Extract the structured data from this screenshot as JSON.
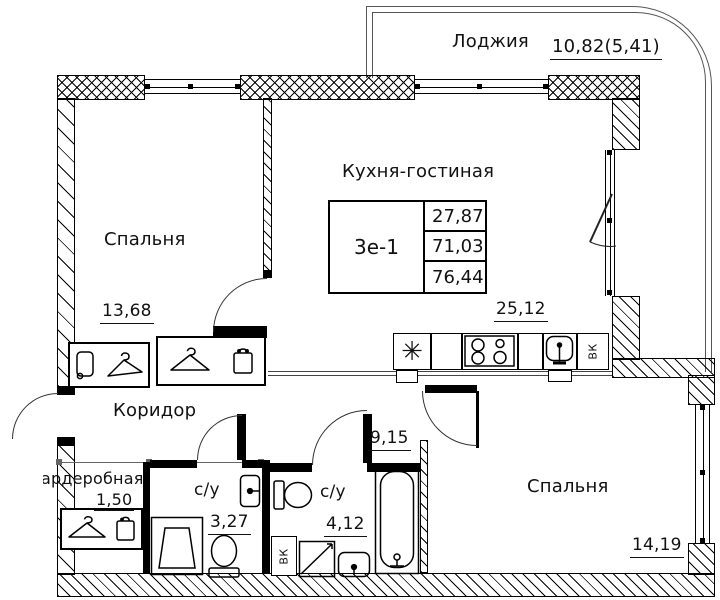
{
  "plan": {
    "title": "Apartment floor plan 3e-1",
    "rooms": [
      {
        "id": "loggia",
        "name": "Лоджия",
        "area": "10,82(5,41)"
      },
      {
        "id": "bedroom-left",
        "name": "Спальня",
        "area": "13,68"
      },
      {
        "id": "kitchen-living",
        "name": "Кухня-гостиная",
        "area": "25,12"
      },
      {
        "id": "corridor",
        "name": "Коридор",
        "area": "9,15"
      },
      {
        "id": "wardrobe-room",
        "name": "Гардеробная",
        "area": "1,50"
      },
      {
        "id": "bathroom-1",
        "name": "с/у",
        "area": "3,27"
      },
      {
        "id": "bathroom-2",
        "name": "с/у",
        "area": "4,12"
      },
      {
        "id": "bedroom-right",
        "name": "Спальня",
        "area": "14,19"
      }
    ],
    "info_table": {
      "unit": "3е-1",
      "values": [
        "27,87",
        "71,03",
        "76,44"
      ]
    },
    "shaft_label": "ВК",
    "icons": {
      "fridge": "✳",
      "hanger": "hanger-icon",
      "box": "storage-box-icon",
      "cabinet": "cabinet-icon"
    },
    "colors": {
      "wall": "#000000",
      "background": "#ffffff",
      "text": "#111111",
      "thin_line": "#555555"
    }
  }
}
